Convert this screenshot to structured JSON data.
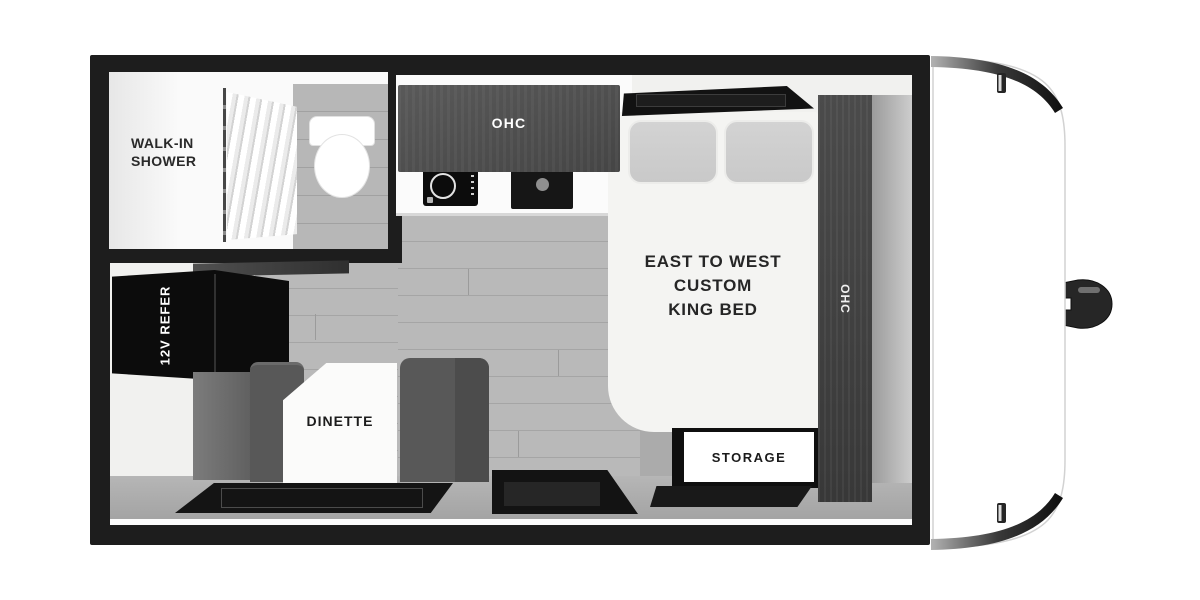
{
  "labels": {
    "bathroom": {
      "line1": "WALK-IN",
      "line2": "SHOWER"
    },
    "kitchen_ohc": "OHC",
    "bedroom_ohc": "OHC",
    "refrigerator": "12V REFER",
    "dinette": "DINETTE",
    "storage": "STORAGE",
    "bed": {
      "line1": "EAST TO WEST",
      "line2": "CUSTOM",
      "line3": "KING BED"
    }
  },
  "colors": {
    "wall": "#1d1d1d",
    "cabinet_wood_dark": "#454545",
    "appliance_black": "#0c0c0c",
    "floor_plank": "#b9b9b9",
    "walkway_gray": "#ababab",
    "bench_gray": "#585858",
    "bed_white": "#f4f4f2",
    "pillow_gray": "#c9c9c9",
    "label_dark": "#262626",
    "label_light": "#ffffff"
  }
}
